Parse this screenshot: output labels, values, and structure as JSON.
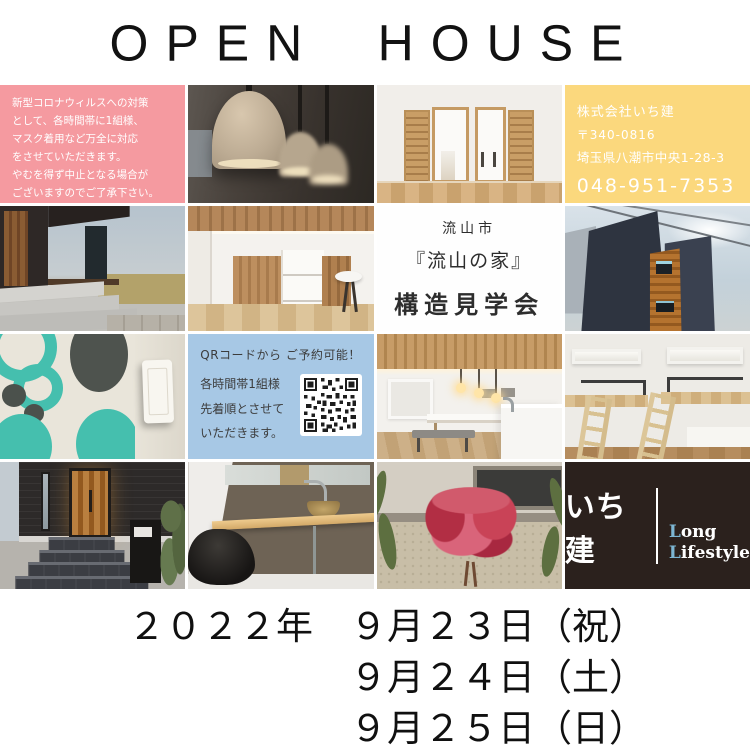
{
  "page": {
    "title": "OPEN HOUSE"
  },
  "covid_notice": {
    "lines": [
      "新型コロナウィルスへの対策",
      "として、各時間帯に1組様、",
      "マスク着用など万全に対応",
      "をさせていただきます。",
      "やむを得ず中止となる場合が",
      "ございますのでご了承下さい。"
    ]
  },
  "company_info": {
    "name": "株式会社いち建",
    "postal_code": "〒340-0816",
    "address": "埼玉県八潮市中央1-28-3",
    "phone": "048-951-7353"
  },
  "event": {
    "city": "流山市",
    "house_name": "『流山の家』",
    "event_type": "構造見学会"
  },
  "reservation": {
    "headline": "QRコードから ご予約可能！",
    "lines": [
      "各時間帯1組様",
      "先着順とさせて",
      "いただきます。"
    ],
    "qr_icon": "qr-code"
  },
  "logo": {
    "brand": "いち建",
    "word1_initial": "L",
    "word1_rest": "ong",
    "word2_initial": "L",
    "word2_rest": "ifestyle",
    "accent_color": "#7db6d3"
  },
  "dates": {
    "line1": "２０２２年　９月２３日（祝）",
    "line2": "９月２４日（土）",
    "line3": "９月２５日（日）"
  },
  "colors": {
    "covid_bg": "#f59aa0",
    "company_bg": "#fbd87d",
    "reservation_bg": "#a7c8e5",
    "logo_bg": "#2b211d",
    "page_bg": "#ffffff"
  }
}
